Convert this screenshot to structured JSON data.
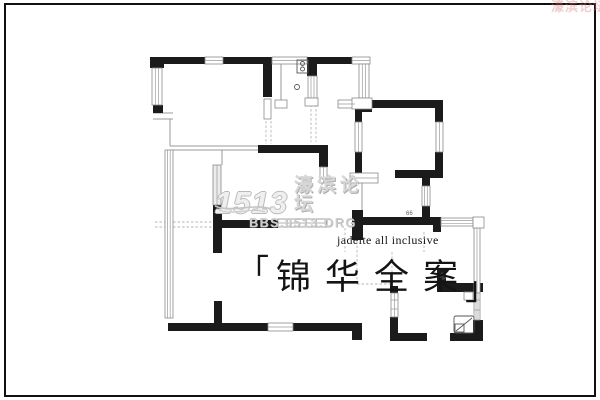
{
  "page": {
    "background": "#ffffff",
    "border_color": "#101010"
  },
  "floor_plan": {
    "wall_color": "#1b1b1b",
    "room_label": "66",
    "fixtures": [
      "stove-icon",
      "sink-circle-icon",
      "light-symbol-icon",
      "toilet-icon"
    ]
  },
  "watermark_center": {
    "logo": "1513",
    "site_name": "濠滨论坛",
    "site_url": "BBS.0513.ORG",
    "color": "#c9c9c9"
  },
  "watermark_corner": {
    "text": "濠滨论坛",
    "color": "#d87d7d"
  },
  "caption": {
    "subtitle": "jadeite all inclusive",
    "bracket_open": "「",
    "bracket_close": "」",
    "title_chars": [
      "锦",
      "华",
      "全",
      "案"
    ]
  }
}
